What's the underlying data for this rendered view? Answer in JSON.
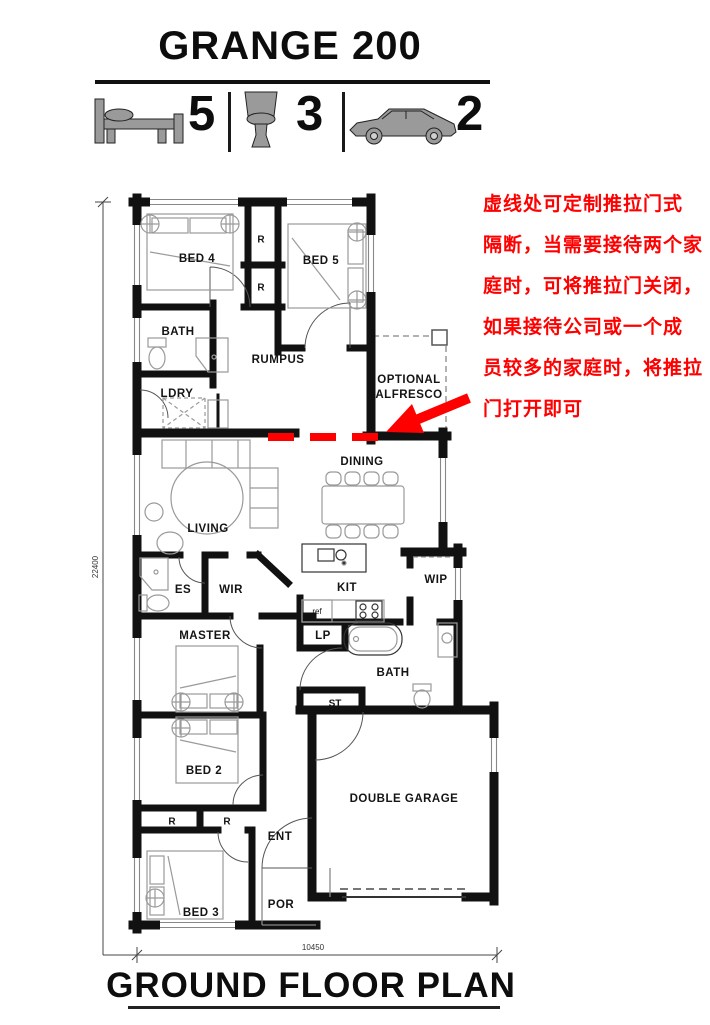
{
  "header": {
    "title": "GRANGE 200"
  },
  "stats": {
    "beds": "5",
    "baths": "3",
    "cars": "2",
    "icons": [
      "bed-icon",
      "toilet-icon",
      "car-icon"
    ]
  },
  "annotation": {
    "color": "#fe0000",
    "lines": [
      "虚线处可定制推拉门式",
      "隔断，当需要接待两个家",
      "庭时，可将推拉门关闭，",
      "如果接待公司或一个成",
      "员较多的家庭时，将推拉",
      "门打开即可"
    ]
  },
  "plan": {
    "rooms": {
      "bed4": "BED 4",
      "bed5": "BED 5",
      "r1": "R",
      "r2": "R",
      "bath_top": "BATH",
      "rumpus": "RUMPUS",
      "ldry": "LDRY",
      "alfresco_line1": "OPTIONAL",
      "alfresco_line2": "ALFRESCO",
      "dining": "DINING",
      "living": "LIVING",
      "es": "ES",
      "wir": "WIR",
      "master": "MASTER",
      "kit": "KIT",
      "wip": "WIP",
      "ref": "ref",
      "lp": "LP",
      "bath_main": "BATH",
      "st": "ST",
      "bed2": "BED 2",
      "r3": "R",
      "r4": "R",
      "ent": "ENT",
      "bed3": "BED 3",
      "por": "POR",
      "garage": "DOUBLE GARAGE"
    },
    "dimensions": {
      "depth": "22400",
      "width": "10450"
    }
  },
  "footer": {
    "title": "GROUND FLOOR PLAN"
  }
}
